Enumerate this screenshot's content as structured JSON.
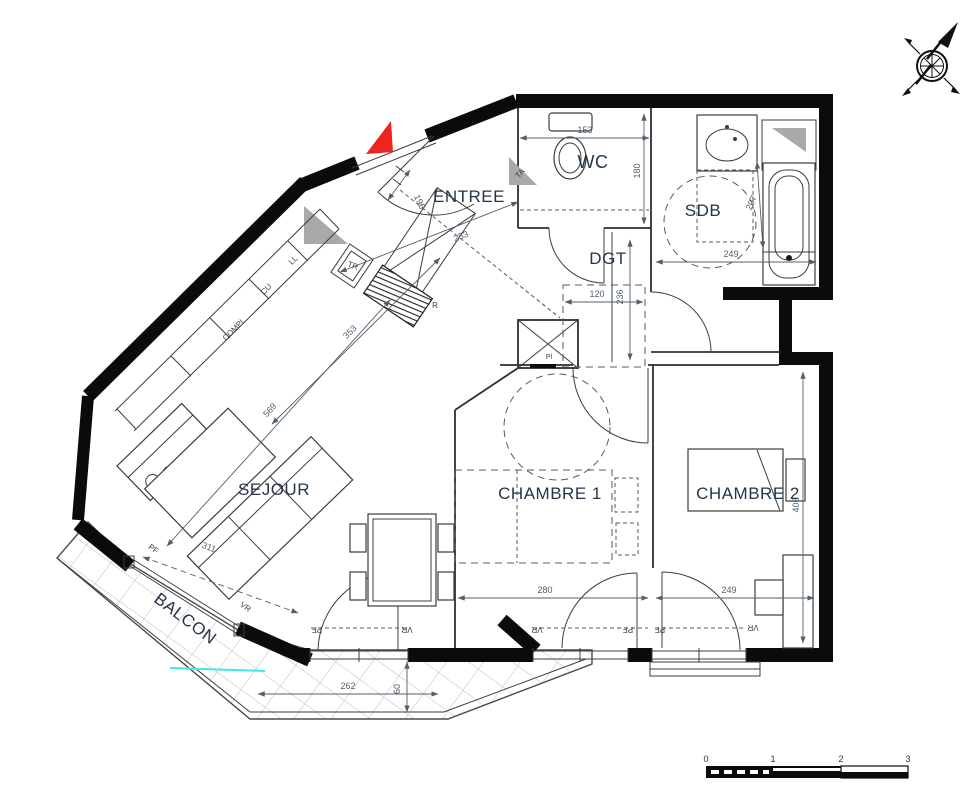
{
  "rooms": {
    "entree": "ENTREE",
    "wc": "WC",
    "sdb": "SDB",
    "dgt": "DGT",
    "sejour": "SEJOUR",
    "chambre1": "CHAMBRE 1",
    "chambre2": "CHAMBRE 2",
    "balcon": "BALCON"
  },
  "fixtures": {
    "ll": "LL",
    "cu": "CU",
    "compl": "COMPL",
    "tr": "TR",
    "r": "R",
    "ta": "TA",
    "pl": "Pl"
  },
  "openings": {
    "pf": "PF",
    "vr": "VR"
  },
  "dimensions": {
    "wc_width": "153",
    "wc_depth": "180",
    "sdb_width": "249",
    "sdb_diag": "207",
    "entree_length": "253",
    "entry_door": "196",
    "kitchen_length": "353",
    "sejour_length": "569",
    "sejour_width": "311",
    "dgt_width": "120",
    "dgt_length": "236",
    "chambre1_width": "280",
    "chambre2_width": "249",
    "chambre2_depth": "406",
    "balcon_length": "262",
    "balcon_depth": "60"
  },
  "scale_bar": {
    "ticks": [
      "0",
      "1",
      "2",
      "3"
    ]
  },
  "colors": {
    "wall": "#0b0b0b",
    "red_marker": "#ee2420",
    "cyan_line": "#45e6e6",
    "dim_text": "#51606e",
    "room_text": "#23364a",
    "gray_fill": "#a9a9a9"
  }
}
